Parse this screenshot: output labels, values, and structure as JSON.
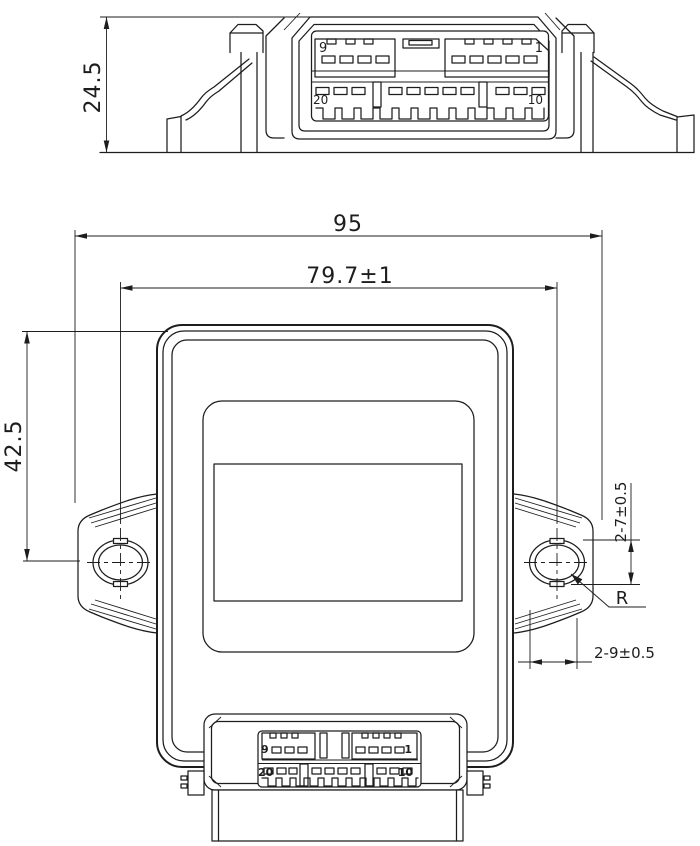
{
  "drawing": {
    "type": "engineering-dimension-drawing",
    "colors": {
      "line": "#1d1d1d",
      "background": "#ffffff"
    },
    "top_view": {
      "dim_height": "24.5",
      "pin_top_left": "9",
      "pin_top_right": "1",
      "pin_bottom_left": "20",
      "pin_bottom_right": "10"
    },
    "front_view": {
      "dim_overall_width": "95",
      "dim_hole_spacing": "79.7±1",
      "dim_hole_center_height": "42.5",
      "dim_hole_height": "2-7±0.5",
      "dim_radius": "R",
      "dim_hole_width": "2-9±0.5",
      "pin_top_left": "9",
      "pin_top_right": "1",
      "pin_bottom_left": "20",
      "pin_bottom_right": "10"
    }
  }
}
